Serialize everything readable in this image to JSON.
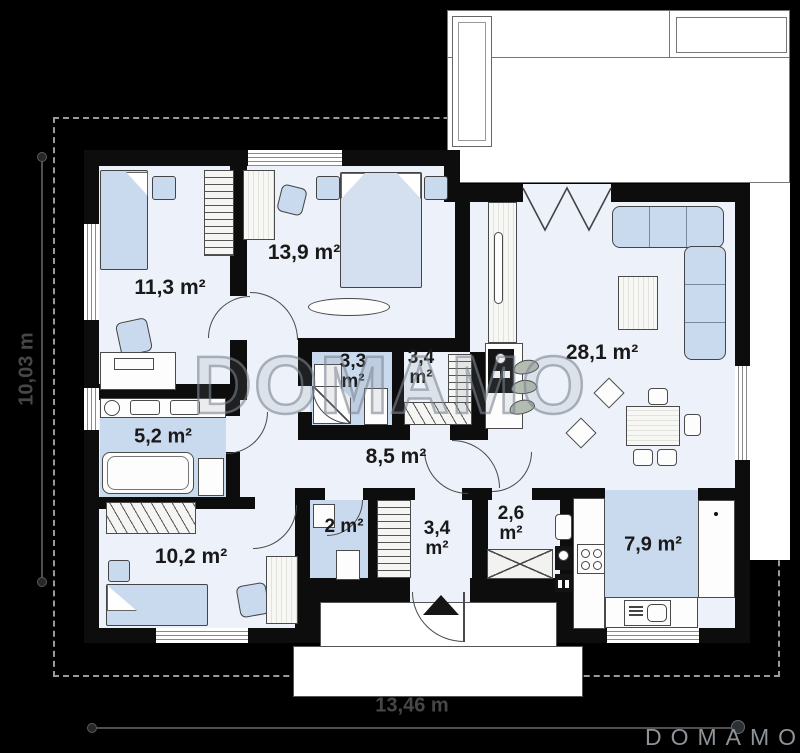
{
  "colors": {
    "bg": "#000000",
    "wall": "#0d0d0d",
    "floor": "#edf1f9",
    "blue": "#c9d9ee",
    "dash_border": "#9a9a9a",
    "dimension": "#474747",
    "logo_gray": "#8e939a"
  },
  "watermark": {
    "text": "DOMAMO"
  },
  "brand": {
    "logo_text": "DOMAMO"
  },
  "dimensions": {
    "width_label": "13,46 m",
    "height_label": "10,03 m"
  },
  "rooms": [
    {
      "name": "bedroom-1",
      "area": "11,3 m²"
    },
    {
      "name": "bedroom-2",
      "area": "13,9 m²"
    },
    {
      "name": "bathroom-1",
      "area": "3,3 m²"
    },
    {
      "name": "wardrobe-1",
      "area": "3,4 m²"
    },
    {
      "name": "living-room",
      "area": "28,1 m²"
    },
    {
      "name": "bathroom-2",
      "area": "5,2 m²"
    },
    {
      "name": "hall",
      "area": "8,5 m²"
    },
    {
      "name": "bedroom-3",
      "area": "10,2 m²"
    },
    {
      "name": "wc",
      "area": "2 m²"
    },
    {
      "name": "wardrobe-2",
      "area": "3,4 m²"
    },
    {
      "name": "vestibule",
      "area": "2,6 m²"
    },
    {
      "name": "kitchen",
      "area": "7,9 m²"
    }
  ]
}
